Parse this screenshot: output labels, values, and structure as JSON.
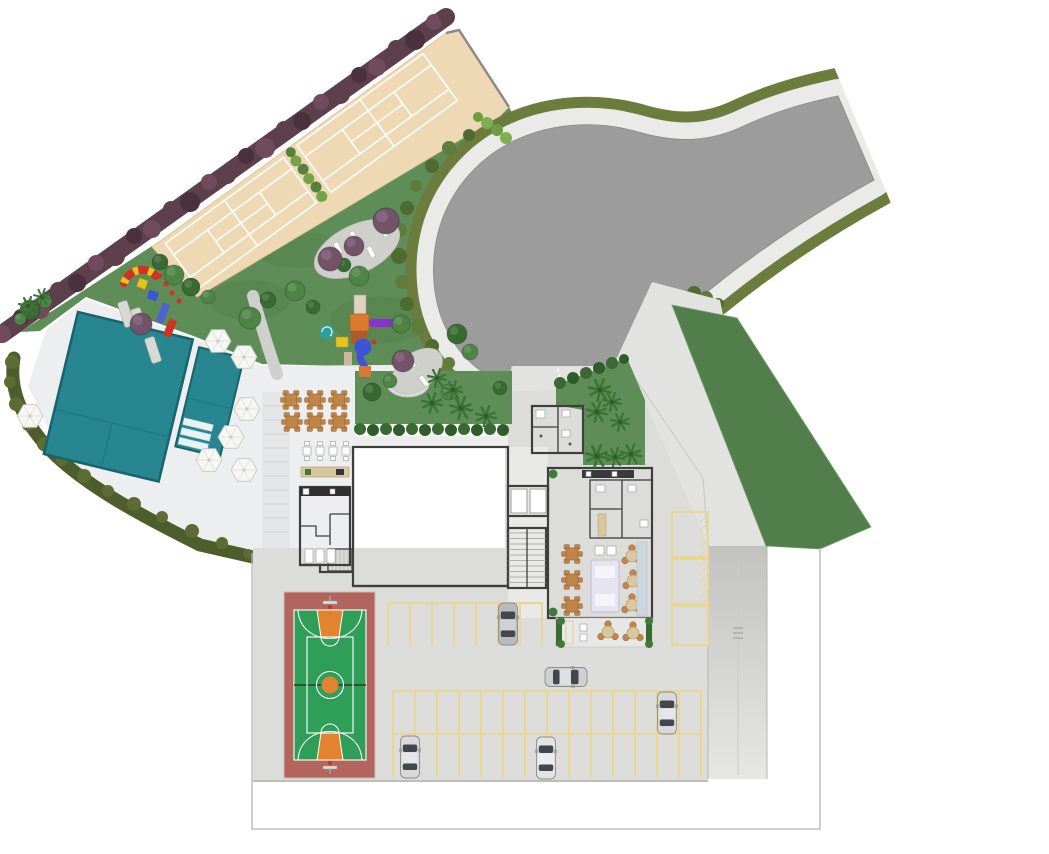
{
  "plan": {
    "kind": "residential-site-plan",
    "areas": [
      "tennis-courts",
      "toddler-playground",
      "play-structure",
      "swimming-pool",
      "kids-pool",
      "pool-deck",
      "picnic-area",
      "barbecue-kitchen",
      "changing-rooms",
      "main-hall",
      "elevator-core",
      "stairs",
      "entrance-lobby",
      "party-lounge",
      "lounge-terrace",
      "access-road-loop",
      "entrance-garden",
      "landscaped-slope",
      "parking-lot",
      "ramp",
      "basketball-court"
    ],
    "objects": {
      "cars": 5,
      "umbrellas": 7,
      "picnic_tables": 6,
      "tennis_courts": 2,
      "lounge_tables": 3
    }
  },
  "colors": {
    "bg": "#ffffff",
    "grass": "#5f8d58",
    "lawn": "#527e4b",
    "hedge_purple": "#5e3f4c",
    "hedge_purple2": "#6f4b5c",
    "hedge_purple3": "#49323d",
    "hedge_olive": "#6b7c3c",
    "hedge_dark": "#4d5e2c",
    "bush_green": "#7fae52",
    "tree_green": "#4f8447",
    "tree_dark": "#3a6a33",
    "tree_purple": "#72536a",
    "palm": "#3c7437",
    "court_beige": "#efd9b4",
    "divider_green": "#76a24a",
    "road": "#9c9c9c",
    "sidewalk": "#eaeae8",
    "pool": "#27868f",
    "deck": "#edeeef",
    "pavement": "#dcdcda",
    "pavement_light": "#e2e2e0",
    "stall": "#e9d68f",
    "bball_red": "#b2655c",
    "bball_green": "#2f9e58",
    "bball_orange": "#e2832f",
    "wall": "#3e3e3e",
    "floor": "#ededeb",
    "lounge_floor": "#d8dada",
    "hatch_bg": "#f3f3f1",
    "hatch_line": "#bfbfbd",
    "table": "#bf8549",
    "counter": "#d9c7a0",
    "sofa": "#e6e4f0",
    "blue_item": "#3b55d6",
    "orange_item": "#d97a2e",
    "purple_item": "#8833cc",
    "yellow_item": "#e6c31f",
    "red_item": "#cf3323",
    "teal_item": "#2aa198",
    "car": "#d7d8d8",
    "glass": "#42464d",
    "umbrella": "#f6f6f2",
    "boundary": "#b4b4b2"
  }
}
